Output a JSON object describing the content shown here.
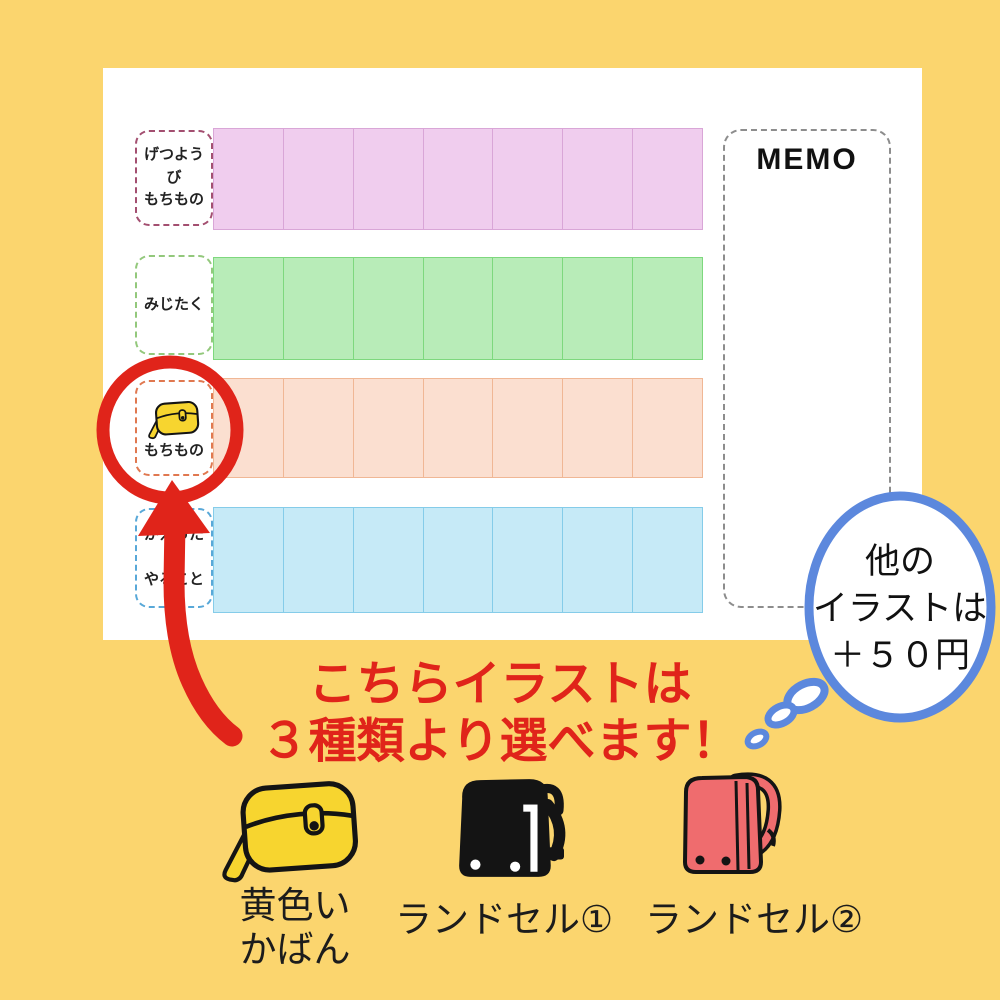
{
  "colors": {
    "background": "#fbd56e",
    "card": "#ffffff",
    "accent_red": "#e0241a",
    "bubble_blue": "#5c88dd",
    "bag_yellow": "#f7d52f",
    "randoseru_red": "#ef6c6e",
    "ink": "#141414"
  },
  "schedule": {
    "memo_title": "MEMO",
    "columns_per_row": 7,
    "rows": [
      {
        "lines": [
          "げつようび",
          "もちもの"
        ],
        "fill": "#f0cdee",
        "line": "#d9a6d7",
        "label_border": "#a34f70"
      },
      {
        "lines": [
          "みじたく"
        ],
        "fill": "#b8ecb8",
        "line": "#7ed87e",
        "label_border": "#93c87c"
      },
      {
        "lines": [
          "もちもの"
        ],
        "icon": "yellow-bag-icon",
        "fill": "#fbdfd0",
        "line": "#f0b795",
        "label_border": "#e07850"
      },
      {
        "lines": [
          "かえったら",
          "やること"
        ],
        "fill": "#c6eaf7",
        "line": "#85cce9",
        "label_border": "#58a8d8"
      }
    ]
  },
  "annotations": {
    "bubble": [
      "他の",
      "イラストは",
      "＋５０円"
    ],
    "headline": [
      "こちらイラストは",
      "３種類より選べます！"
    ]
  },
  "options": [
    {
      "icon": "yellow-bag-icon",
      "lines": [
        "黄色い",
        "かばん"
      ]
    },
    {
      "icon": "black-randoseru-icon",
      "lines": [
        "ランドセル①"
      ]
    },
    {
      "icon": "red-randoseru-icon",
      "lines": [
        "ランドセル②"
      ]
    }
  ]
}
